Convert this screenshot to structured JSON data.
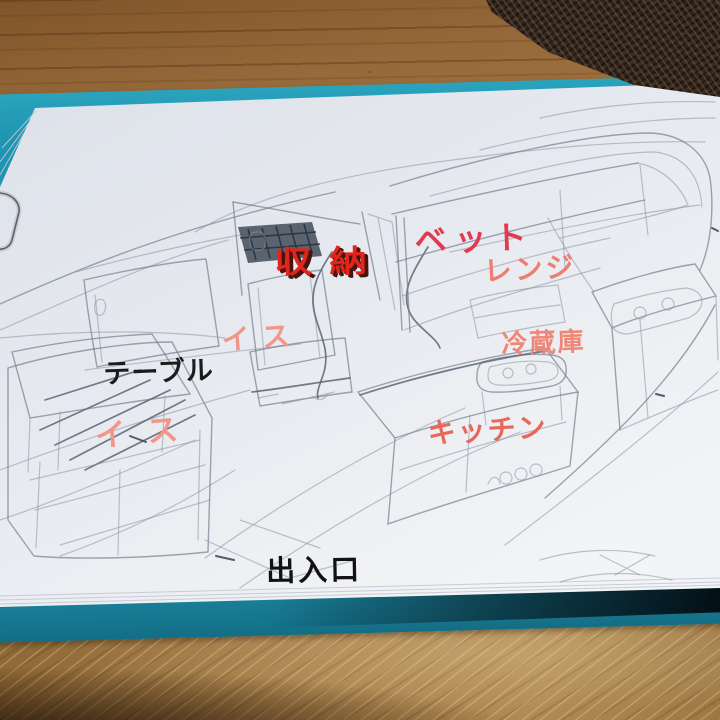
{
  "scene": {
    "subject": "Hand-drawn camper van interior layout sketch on paper, clipped to a teal clipboard on a wooden table"
  },
  "annotations": {
    "storage": {
      "text": "収納",
      "color": "#e1251b"
    },
    "bed": {
      "text": "ベット",
      "color": "#e23950"
    },
    "range": {
      "text": "レンジ",
      "color": "#ee7e71"
    },
    "fridge": {
      "text": "冷蔵庫",
      "color": "#ef8677"
    },
    "kitchen": {
      "text": "キッチン",
      "color": "#e5685b"
    },
    "chair_upper": {
      "text": "イス",
      "color": "#f2968c"
    },
    "table": {
      "text": "テーブル",
      "color": "#1b1b1d"
    },
    "chair_lower": {
      "text": "イス",
      "color": "#f2958b"
    },
    "entrance": {
      "text": "出入口",
      "color": "#121214"
    }
  },
  "palette": {
    "clipboard_teal": "#1f95b2",
    "paper": "#e6e9ef",
    "wood_top": "#96693a",
    "wood_bottom": "#a8824d",
    "mesh_basket": "#2f241c",
    "pencil": "#7d8697"
  }
}
